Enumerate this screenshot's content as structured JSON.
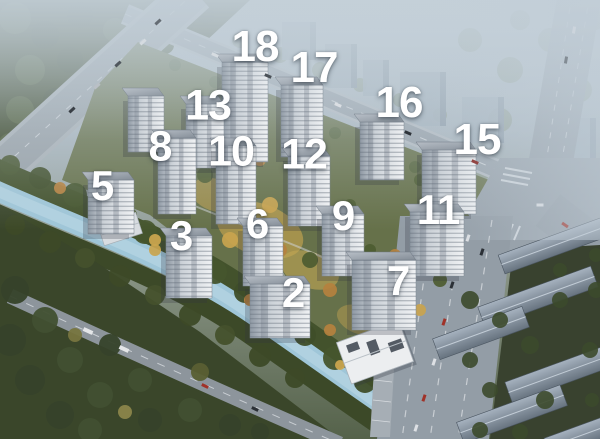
{
  "scene": {
    "label_color": "#ffffff"
  },
  "colors": {
    "river": "#9fc6d8",
    "haze": "#c4d0d9",
    "forest": "#35412a",
    "road": "#949ea8",
    "tower_facade": "#dfe3e7"
  },
  "building_labels": [
    {
      "text": "18",
      "x": 255,
      "y": 47,
      "size": 44
    },
    {
      "text": "17",
      "x": 314,
      "y": 68,
      "size": 44
    },
    {
      "text": "13",
      "x": 208,
      "y": 106,
      "size": 43
    },
    {
      "text": "16",
      "x": 399,
      "y": 103,
      "size": 44
    },
    {
      "text": "15",
      "x": 477,
      "y": 140,
      "size": 44
    },
    {
      "text": "8",
      "x": 160,
      "y": 147,
      "size": 43
    },
    {
      "text": "10",
      "x": 231,
      "y": 152,
      "size": 43
    },
    {
      "text": "12",
      "x": 304,
      "y": 155,
      "size": 43
    },
    {
      "text": "5",
      "x": 102,
      "y": 186,
      "size": 42
    },
    {
      "text": "3",
      "x": 181,
      "y": 236,
      "size": 42
    },
    {
      "text": "6",
      "x": 257,
      "y": 224,
      "size": 42
    },
    {
      "text": "9",
      "x": 343,
      "y": 216,
      "size": 42
    },
    {
      "text": "11",
      "x": 438,
      "y": 210,
      "size": 42
    },
    {
      "text": "2",
      "x": 293,
      "y": 293,
      "size": 42
    },
    {
      "text": "7",
      "x": 398,
      "y": 281,
      "size": 42
    }
  ]
}
